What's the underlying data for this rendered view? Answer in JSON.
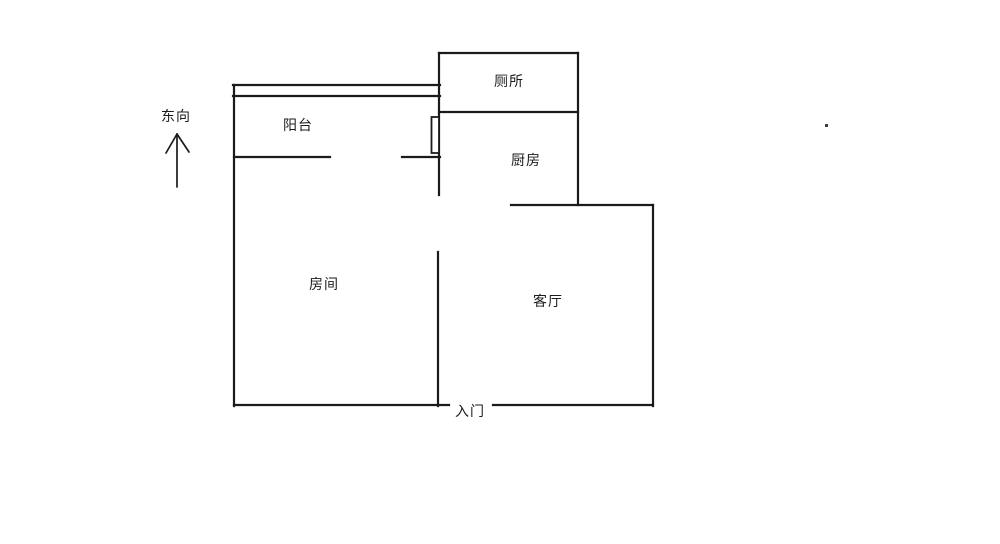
{
  "compass": {
    "label": "东向"
  },
  "rooms": {
    "balcony": {
      "label": "阳台"
    },
    "toilet": {
      "label": "厕所"
    },
    "kitchen": {
      "label": "厨房"
    },
    "bedroom": {
      "label": "房间"
    },
    "living_room": {
      "label": "客厅"
    }
  },
  "entrance": {
    "label": "入门"
  },
  "colors": {
    "wall": "#1b1b1b",
    "text": "#1b1b1b",
    "background": "#ffffff"
  }
}
